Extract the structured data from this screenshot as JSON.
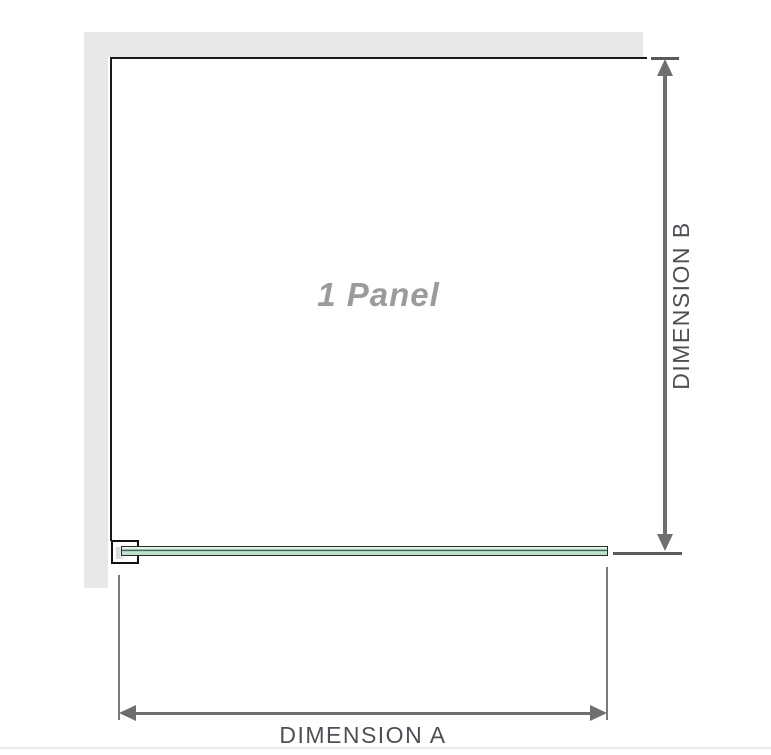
{
  "diagram": {
    "panel": {
      "label": "1 Panel"
    },
    "dimensions": {
      "a": {
        "label": "DIMENSION A"
      },
      "b": {
        "label": "DIMENSION B"
      }
    },
    "colors": {
      "wall": "#e8e8e8",
      "panel_border": "#1a1a1a",
      "glass_fill_light": "#d5eddf",
      "glass_stripe": "#44685a",
      "dimension_line": "#6e6e6e",
      "dimension_tick": "#5a5a5a",
      "dimension_text": "#4d5156",
      "panel_label_text": "#9b9b9b",
      "bottom_divider": "#f0e9e5"
    }
  }
}
